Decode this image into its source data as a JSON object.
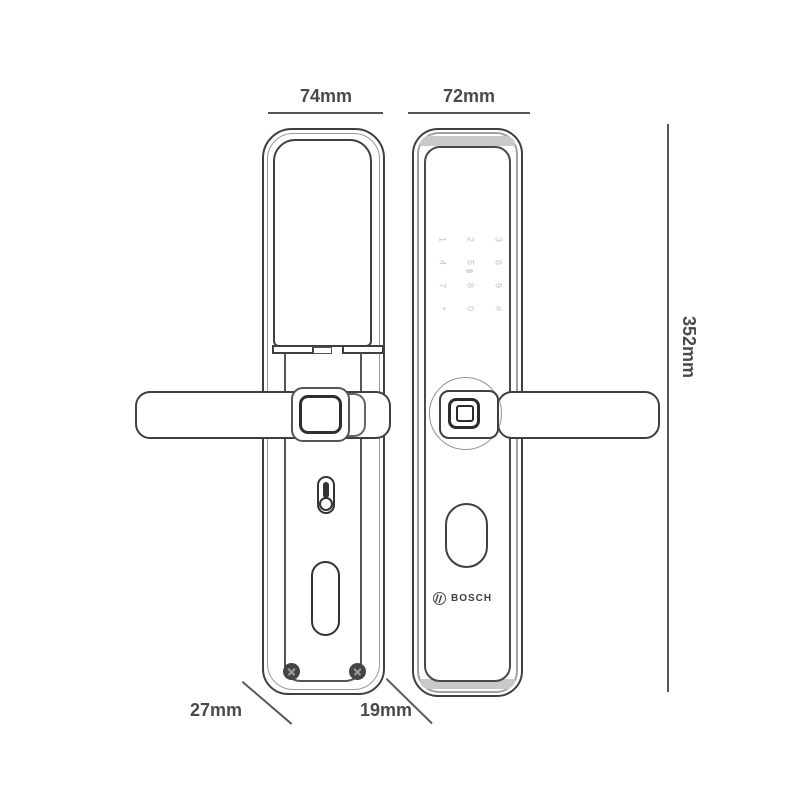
{
  "dimensions": {
    "back_width": "74mm",
    "front_width": "72mm",
    "height": "352mm",
    "back_depth": "27mm",
    "front_depth": "19mm"
  },
  "front_view": {
    "brand": "BOSCH",
    "keypad_keys": [
      "1",
      "2",
      "3",
      "4",
      "5",
      "6",
      "7",
      "8",
      "9",
      "*",
      "0",
      "#"
    ]
  },
  "colors": {
    "line_dark": "#3f3f3f",
    "line_mid": "#555555",
    "line_light": "#9a9a9a",
    "text": "#4a4a4a",
    "keypad_text": "#c2c2c2",
    "background": "#ffffff"
  }
}
